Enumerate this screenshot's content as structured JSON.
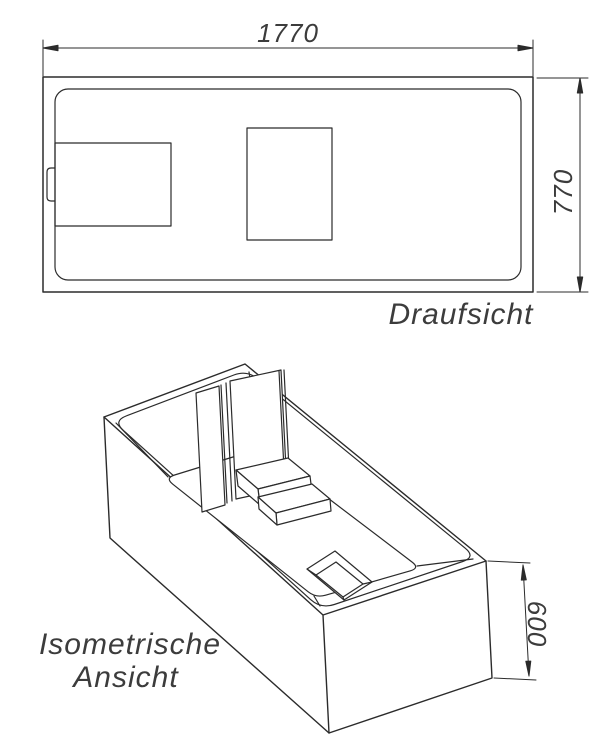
{
  "drawing": {
    "background_color": "#ffffff",
    "line_color": "#2b2b2b",
    "top_view": {
      "caption": "Draufsicht",
      "dim_width": "1770",
      "dim_depth": "770"
    },
    "iso_view": {
      "caption_line1": "Isometrische",
      "caption_line2": "Ansicht",
      "dim_height": "600"
    }
  }
}
